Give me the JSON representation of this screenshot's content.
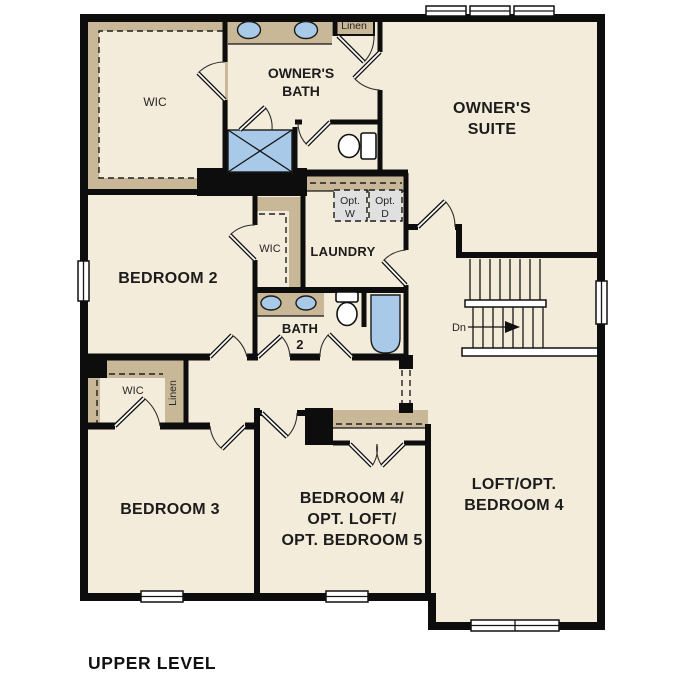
{
  "title": "UPPER LEVEL",
  "colors": {
    "background": "#ffffff",
    "floor": "#f4ecda",
    "wall": "#0d0d0d",
    "casework": "#c9b897",
    "fixture": "#a8c9e7",
    "optional": "#e0e0e0",
    "label": "#1c1c1c"
  },
  "rooms": {
    "wic_owner": {
      "label": "WIC"
    },
    "owners_bath": {
      "line1": "OWNER'S",
      "line2": "BATH"
    },
    "linen_upper": {
      "label": "Linen"
    },
    "owners_suite": {
      "line1": "OWNER'S",
      "line2": "SUITE"
    },
    "bedroom2": {
      "label": "BEDROOM 2"
    },
    "wic_bedroom2": {
      "label": "WIC"
    },
    "laundry": {
      "label": "LAUNDRY"
    },
    "opt_washer": {
      "line1": "Opt.",
      "line2": "W"
    },
    "opt_dryer": {
      "line1": "Opt.",
      "line2": "D"
    },
    "bath2": {
      "line1": "BATH",
      "line2": "2"
    },
    "stairs": {
      "label": "Dn"
    },
    "wic_bedroom3": {
      "label": "WIC"
    },
    "linen_lower": {
      "label": "Linen"
    },
    "bedroom3": {
      "label": "BEDROOM 3"
    },
    "bedroom4": {
      "line1": "BEDROOM 4/",
      "line2": "OPT. LOFT/",
      "line3": "OPT. BEDROOM 5"
    },
    "loft": {
      "line1": "LOFT/OPT.",
      "line2": "BEDROOM 4"
    }
  }
}
